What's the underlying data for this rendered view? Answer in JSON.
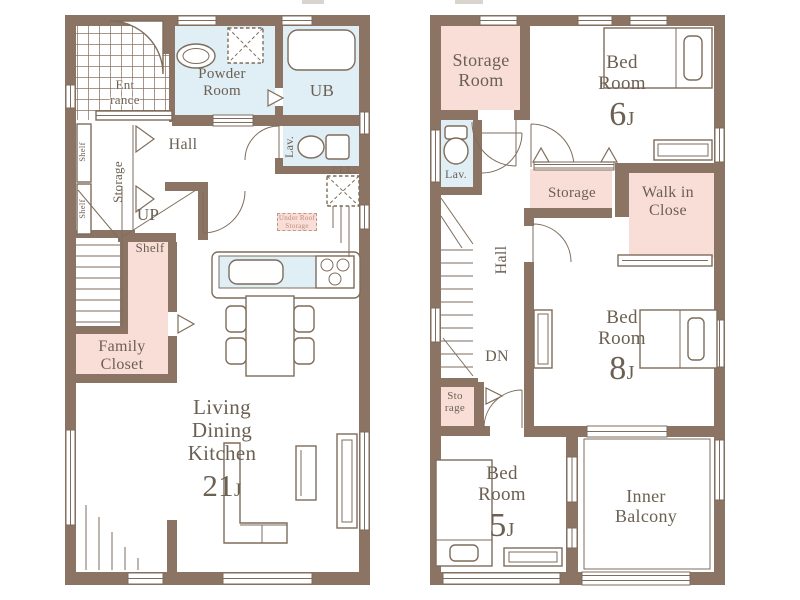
{
  "palette": {
    "wall": "#8b7463",
    "room_pink": "#f9ded7",
    "room_blue": "#e0eef5",
    "line": "#7e6d5c",
    "text": "#6b6052",
    "accent_text": "#c18b7b",
    "paper": "#ffffff"
  },
  "floor1": {
    "entrance": "Ent rance",
    "powder_room": "Powder Room",
    "unit_bath": "UB",
    "lavatory": "Lav.",
    "hall": "Hall",
    "storage": "Storage",
    "shelf_a": "Shelf",
    "shelf_b": "Shelf",
    "stairs_up": "UP",
    "shelf_counter": "Shelf",
    "family_closet": "Family Closet",
    "under_roof_storage": "Under Roof Storage",
    "ldk": "Living Dining Kitchen",
    "ldk_size": "21",
    "ldk_size_unit": "J"
  },
  "floor2": {
    "storage_room": "Storage Room",
    "bedroom_6": "Bed Room",
    "bedroom_6_size": "6",
    "bedroom_6_size_unit": "J",
    "lavatory": "Lav.",
    "storage_closet": "Storage",
    "walk_in_closet": "Walk in Close",
    "hall": "Hall",
    "stairs_down": "DN",
    "storage_small": "Sto rage",
    "bedroom_8": "Bed Room",
    "bedroom_8_size": "8",
    "bedroom_8_size_unit": "J",
    "bedroom_5": "Bed Room",
    "bedroom_5_size": "5",
    "bedroom_5_size_unit": "J",
    "inner_balcony": "Inner Balcony"
  }
}
